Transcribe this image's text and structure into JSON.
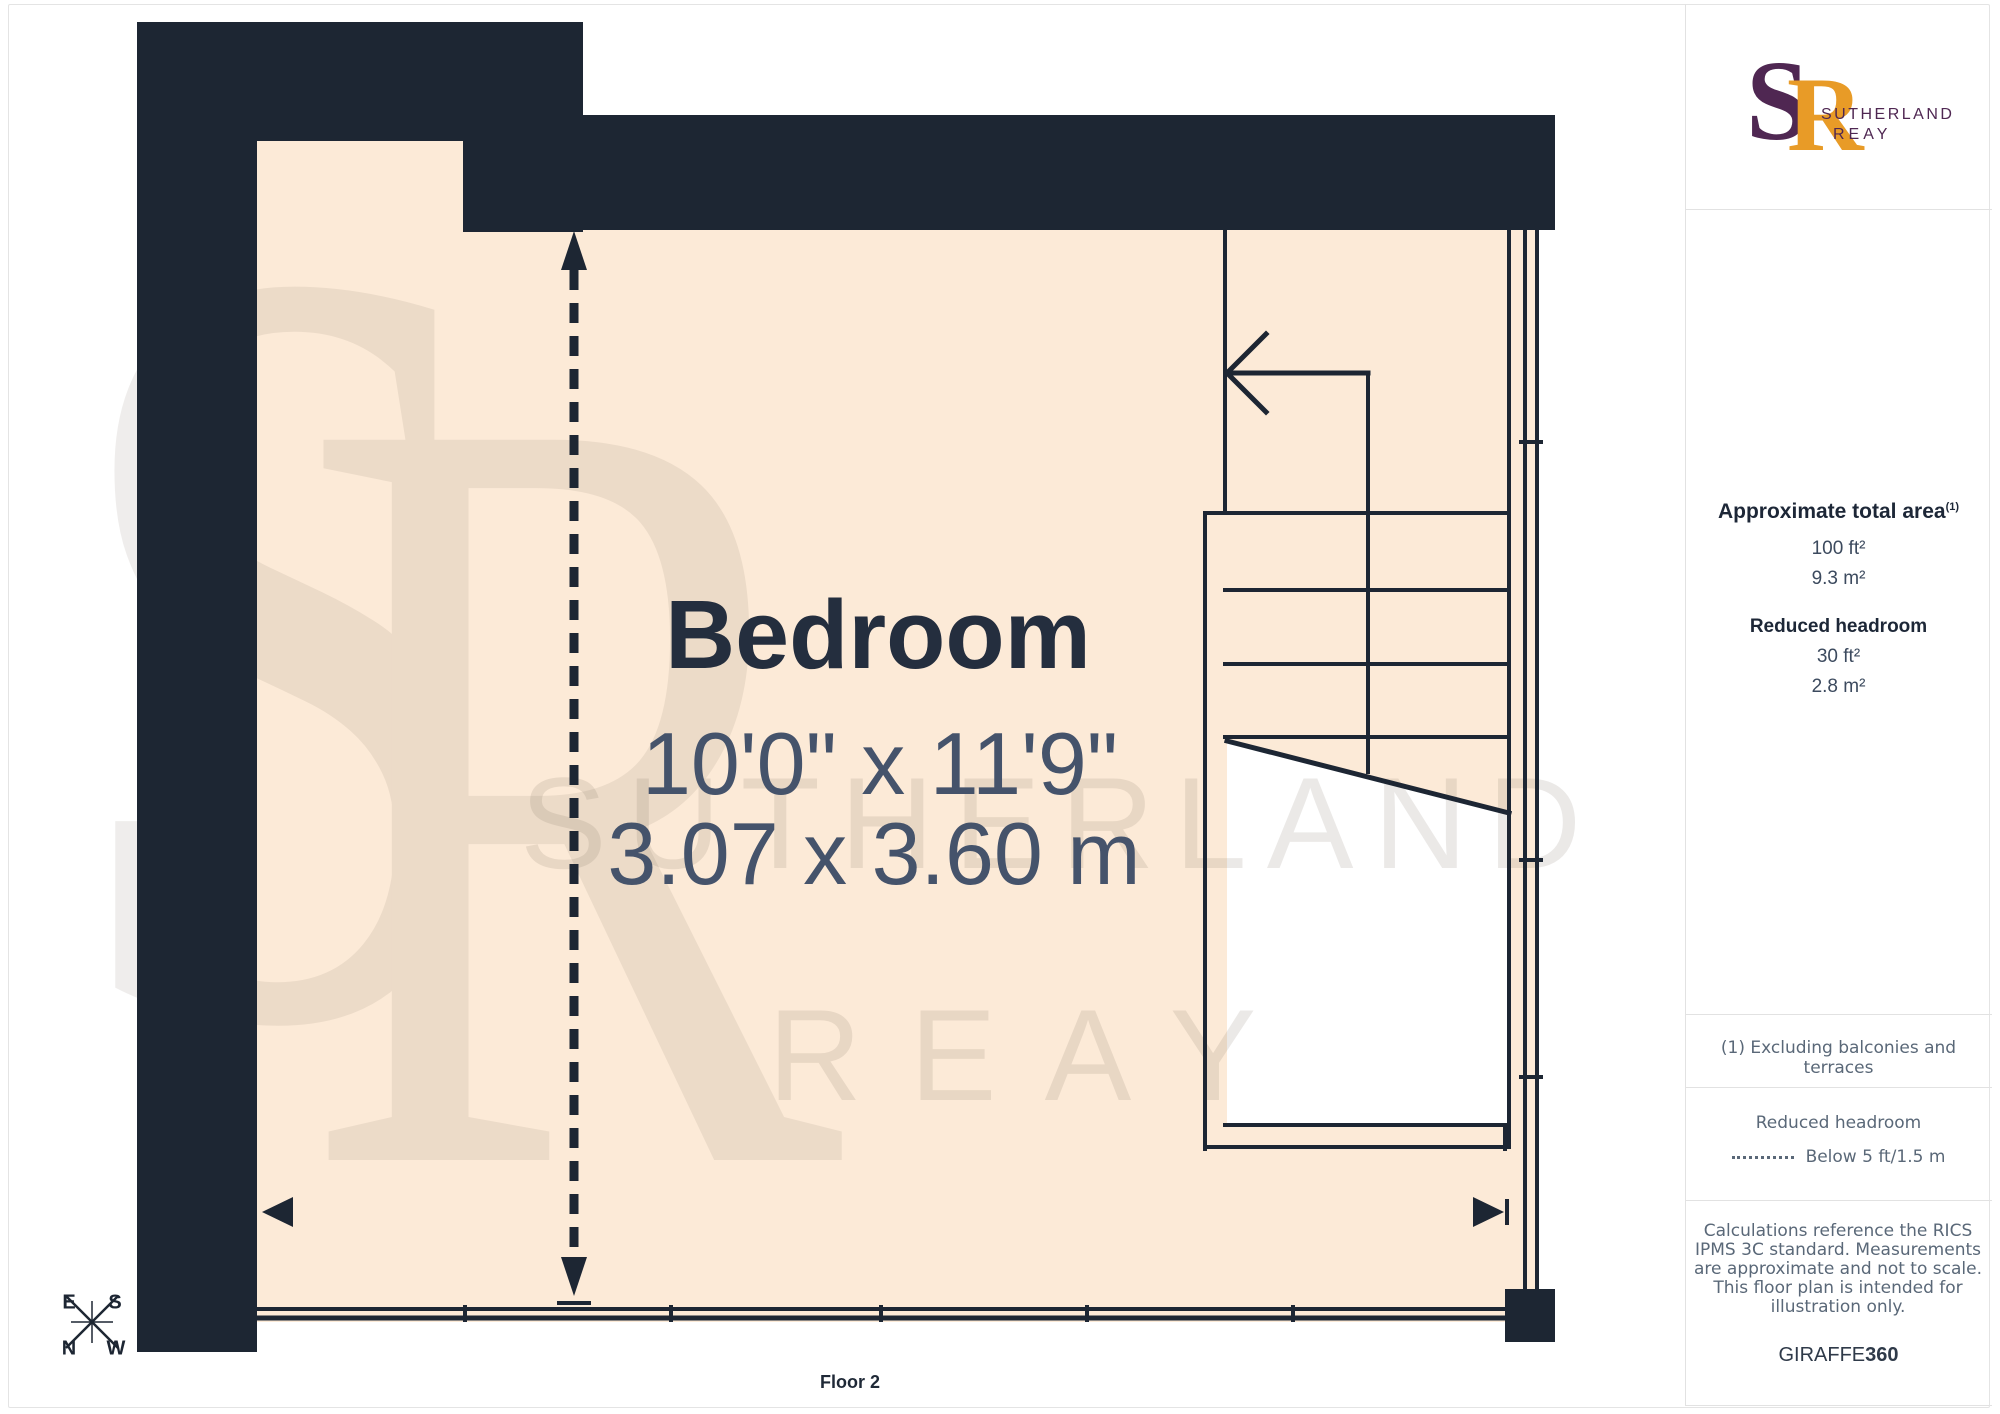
{
  "plan": {
    "room_label": "Bedroom",
    "dim_imperial": "10'0\" x 11'9\"",
    "dim_metric": "3.07 x 3.60 m",
    "floor_label": "Floor 2",
    "compass": {
      "top_left": "E",
      "top_right": "S",
      "bottom_left": "N",
      "bottom_right": "W"
    },
    "watermark": {
      "monogram_s": "S",
      "monogram_r": "R",
      "line1": "SUTHERLAND",
      "line2": "REAY"
    }
  },
  "sidebar": {
    "logo": {
      "monogram_s": "S",
      "monogram_r": "R",
      "name_line1": "SUTHERLAND",
      "name_line2": "REAY"
    },
    "area": {
      "title": "Approximate total area",
      "title_superscript": "(1)",
      "total_ft": "100 ft²",
      "total_m": "9.3 m²",
      "reduced_title": "Reduced headroom",
      "reduced_ft": "30 ft²",
      "reduced_m": "2.8 m²"
    },
    "note": "(1) Excluding balconies and terraces",
    "legend": {
      "title": "Reduced headroom",
      "dash_label": "Below 5 ft/1.5 m"
    },
    "disclaimer": "Calculations reference the RICS IPMS 3C standard. Measurements are approximate and not to scale. This floor plan is intended for illustration only.",
    "brand": {
      "name": "GIRAFFE",
      "suffix": "360"
    }
  },
  "colors": {
    "wall": "#1d2633",
    "floor": "#fcead7",
    "logo_purple": "#4f2752",
    "logo_orange": "#e89b27",
    "note_gray": "#5a6878"
  }
}
